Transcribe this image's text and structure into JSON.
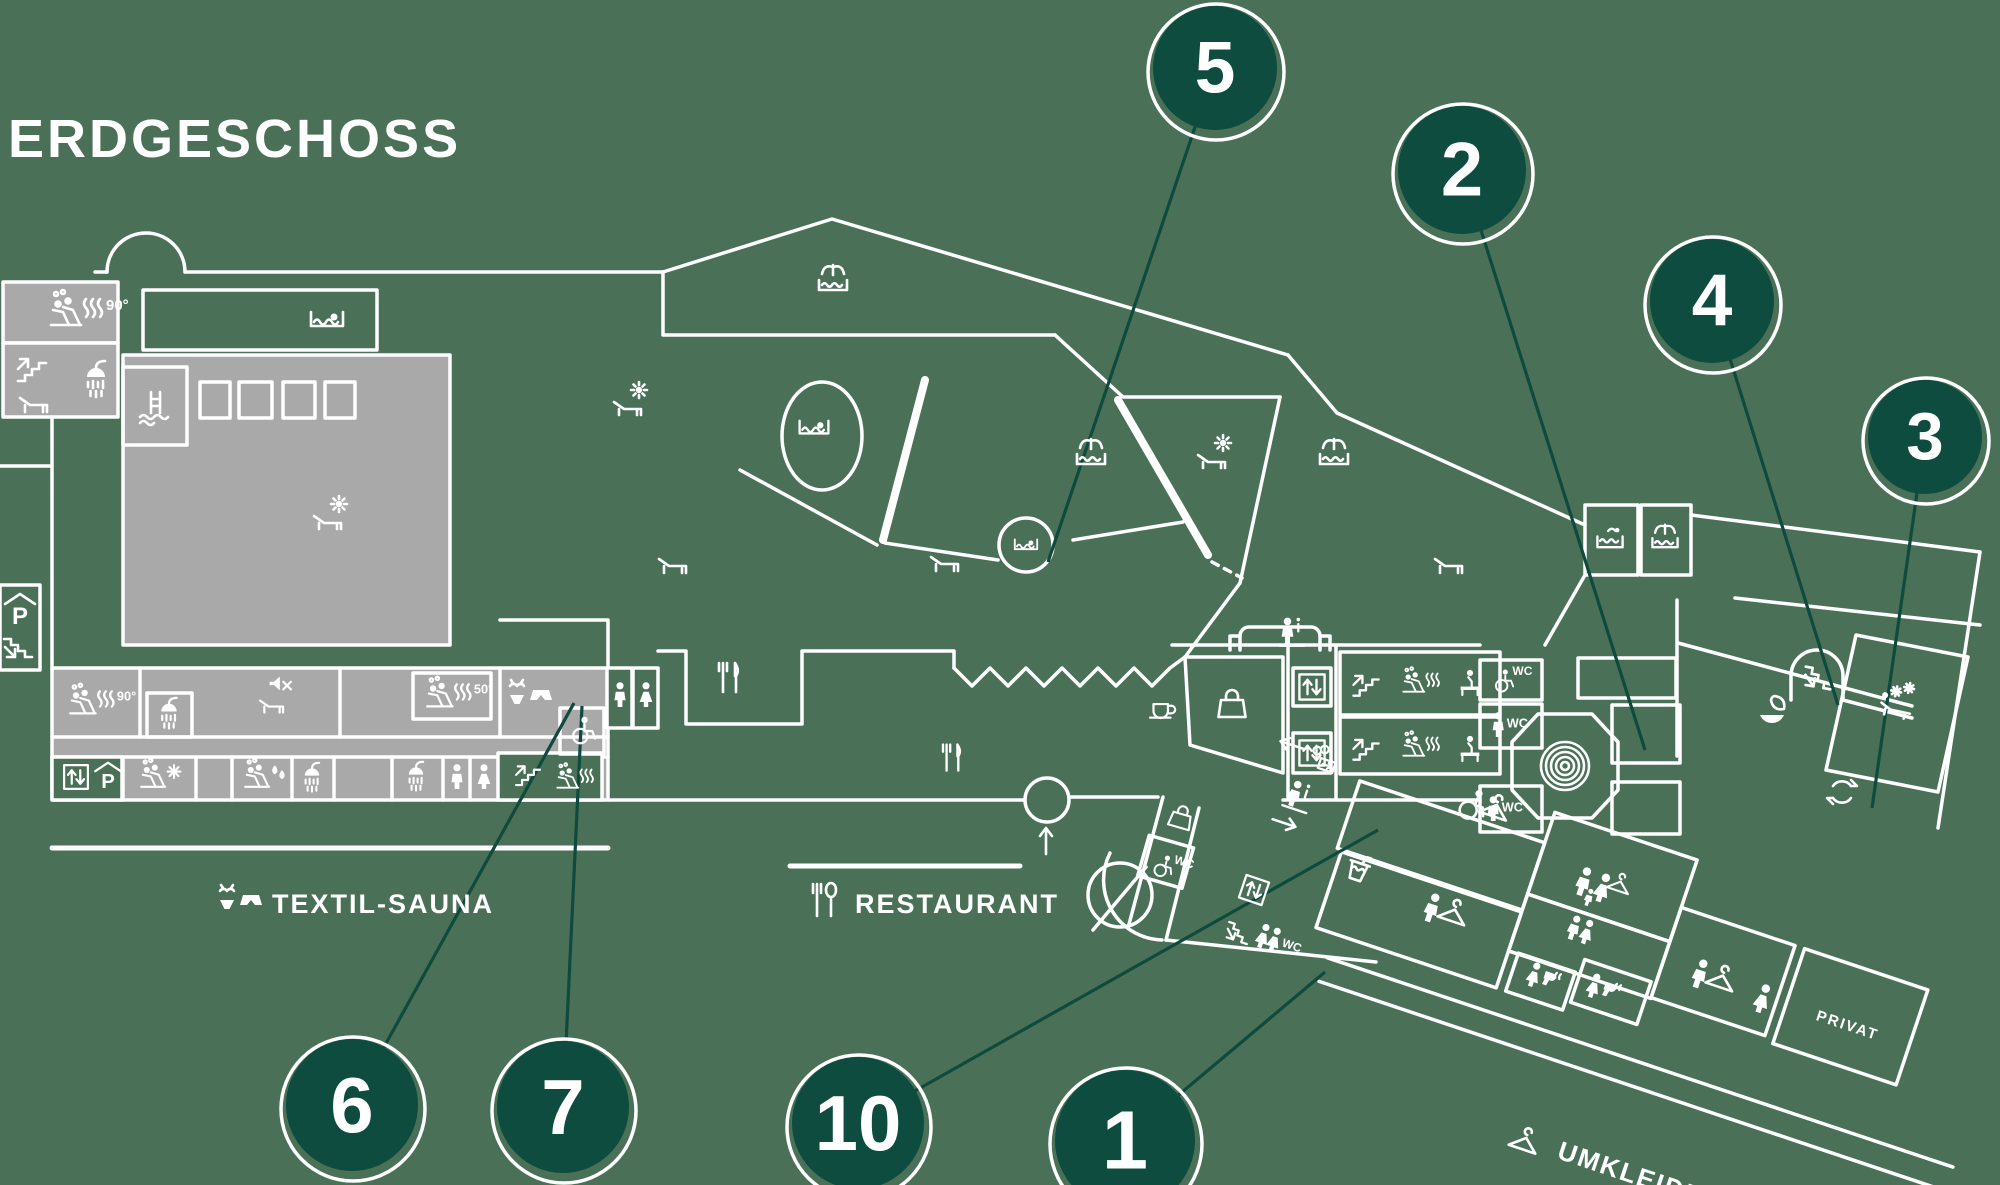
{
  "page": {
    "title": "ERDGESCHOSS"
  },
  "colors": {
    "background": "#4a7157",
    "wall": "#ffffff",
    "area_gray": "#a9a9a9",
    "marker_fill": "#0d4c3e",
    "marker_ring": "#ffffff",
    "leader_line": "#0e4a3d",
    "text": "#ffffff"
  },
  "section_labels": [
    {
      "id": "textil-sauna",
      "text": "TEXTIL-SAUNA",
      "x": 272,
      "y": 913,
      "size": 27,
      "rot": 0,
      "anchor": "start"
    },
    {
      "id": "restaurant",
      "text": "RESTAURANT",
      "x": 855,
      "y": 913,
      "size": 27,
      "rot": 0,
      "anchor": "start"
    },
    {
      "id": "umkleiden",
      "text": "UMKLEIDEN",
      "x": 1556,
      "y": 1158,
      "size": 26,
      "rot": 18.5,
      "anchor": "start"
    },
    {
      "id": "privat",
      "text": "PRIVAT",
      "x": 1846,
      "y": 1030,
      "size": 15,
      "rot": 18.5,
      "anchor": "middle"
    }
  ],
  "markers": [
    {
      "number": "5",
      "cx": 1215,
      "cy": 68,
      "r": 62,
      "tx": 1048,
      "ty": 562
    },
    {
      "number": "2",
      "cx": 1462,
      "cy": 170,
      "r": 64,
      "tx": 1645,
      "ty": 750
    },
    {
      "number": "4",
      "cx": 1712,
      "cy": 301,
      "r": 62,
      "tx": 1838,
      "ty": 705
    },
    {
      "number": "3",
      "cx": 1925,
      "cy": 437,
      "r": 57,
      "tx": 1872,
      "ty": 808
    },
    {
      "number": "6",
      "cx": 352,
      "cy": 1105,
      "r": 66,
      "tx": 574,
      "ty": 703
    },
    {
      "number": "7",
      "cx": 563,
      "cy": 1107,
      "r": 66,
      "tx": 582,
      "ty": 706
    },
    {
      "number": "10",
      "cx": 858,
      "cy": 1123,
      "r": 66,
      "tx": 1378,
      "ty": 830
    },
    {
      "number": "1",
      "cx": 1125,
      "cy": 1140,
      "r": 70,
      "tx": 1325,
      "ty": 972
    }
  ],
  "icons": [
    {
      "name": "sauna-people",
      "x": 72,
      "y": 314,
      "text": "90°"
    },
    {
      "name": "stairs-up",
      "x": 32,
      "y": 368
    },
    {
      "name": "shower",
      "x": 96,
      "y": 380
    },
    {
      "name": "lounger",
      "x": 34,
      "y": 402
    },
    {
      "name": "pool-ladder",
      "x": 155,
      "y": 408
    },
    {
      "name": "swimmer-pool",
      "x": 327,
      "y": 320
    },
    {
      "name": "sun-lounger",
      "x": 330,
      "y": 514
    },
    {
      "name": "parking",
      "x": 20,
      "y": 612
    },
    {
      "name": "stairs-down",
      "x": 18,
      "y": 648
    },
    {
      "name": "sauna-people",
      "x": 88,
      "y": 704,
      "text": "90°",
      "s": 0.85
    },
    {
      "name": "shower",
      "x": 169,
      "y": 714,
      "s": 0.85
    },
    {
      "name": "speaker-off",
      "x": 279,
      "y": 686,
      "s": 0.85
    },
    {
      "name": "lounger",
      "x": 272,
      "y": 704,
      "s": 0.85
    },
    {
      "name": "elevator",
      "x": 76,
      "y": 777,
      "s": 0.85
    },
    {
      "name": "parking",
      "x": 108,
      "y": 778,
      "s": 0.85
    },
    {
      "name": "sauna-snow",
      "x": 158,
      "y": 778,
      "s": 0.8
    },
    {
      "name": "sauna-drops",
      "x": 262,
      "y": 778,
      "s": 0.8
    },
    {
      "name": "shower",
      "x": 312,
      "y": 778,
      "s": 0.8
    },
    {
      "name": "shower",
      "x": 416,
      "y": 777,
      "s": 0.8
    },
    {
      "name": "man",
      "x": 457,
      "y": 778,
      "s": 0.85
    },
    {
      "name": "woman",
      "x": 484,
      "y": 778,
      "s": 0.85
    },
    {
      "name": "stairs-up",
      "x": 528,
      "y": 774,
      "s": 0.85
    },
    {
      "name": "sauna-people",
      "x": 572,
      "y": 780,
      "s": 0.7
    },
    {
      "name": "sauna-people",
      "x": 445,
      "y": 697,
      "text": "50°",
      "s": 0.85
    },
    {
      "name": "swimwear",
      "x": 530,
      "y": 697
    },
    {
      "name": "wheelchair",
      "x": 582,
      "y": 731,
      "s": 0.85
    },
    {
      "name": "man",
      "x": 620,
      "y": 696,
      "s": 0.85
    },
    {
      "name": "woman",
      "x": 646,
      "y": 696,
      "s": 0.85
    },
    {
      "name": "cutlery",
      "x": 729,
      "y": 678
    },
    {
      "name": "cutlery",
      "x": 952,
      "y": 758,
      "s": 0.9
    },
    {
      "name": "cup",
      "x": 1162,
      "y": 710,
      "s": 0.85
    },
    {
      "name": "arrow-up",
      "x": 1046,
      "y": 840
    },
    {
      "name": "bag",
      "x": 1181,
      "y": 818,
      "s": 0.8,
      "rot": 16
    },
    {
      "name": "wc-wheelchair",
      "x": 1166,
      "y": 866,
      "text": "WC",
      "s": 0.8,
      "rot": 16
    },
    {
      "name": "bag",
      "x": 1232,
      "y": 705
    },
    {
      "name": "info-desk",
      "x": 1292,
      "y": 634,
      "s": 0.9
    },
    {
      "name": "elevator",
      "x": 1312,
      "y": 687,
      "s": 0.9
    },
    {
      "name": "elevator",
      "x": 1312,
      "y": 753,
      "s": 0.9
    },
    {
      "name": "stairs-up",
      "x": 1366,
      "y": 684,
      "s": 0.9
    },
    {
      "name": "sauna-people",
      "x": 1418,
      "y": 684,
      "s": 0.7
    },
    {
      "name": "bench-person",
      "x": 1470,
      "y": 684,
      "s": 0.85
    },
    {
      "name": "stairs-up",
      "x": 1366,
      "y": 748,
      "s": 0.9
    },
    {
      "name": "sauna-people",
      "x": 1418,
      "y": 748,
      "s": 0.7
    },
    {
      "name": "bench-person",
      "x": 1470,
      "y": 750,
      "s": 0.85
    },
    {
      "name": "wc-wheelchair",
      "x": 1506,
      "y": 680,
      "text": "WC",
      "s": 0.8
    },
    {
      "name": "man-wc",
      "x": 1505,
      "y": 726,
      "text": "WC",
      "s": 0.85
    },
    {
      "name": "man-wc",
      "x": 1500,
      "y": 810,
      "text": "WC",
      "s": 0.85
    },
    {
      "name": "woman-wheel-locker",
      "x": 1645,
      "y": 728,
      "s": 0.85
    },
    {
      "name": "woman-wheel-locker",
      "x": 1645,
      "y": 806,
      "s": 0.85
    },
    {
      "name": "spiral",
      "x": 1565,
      "y": 766
    },
    {
      "name": "leaf",
      "x": 1772,
      "y": 712
    },
    {
      "name": "stairs-down",
      "x": 1818,
      "y": 678,
      "rot": 10
    },
    {
      "name": "cycle",
      "x": 1842,
      "y": 792
    },
    {
      "name": "snow-bed",
      "x": 1898,
      "y": 702,
      "rot": 12
    },
    {
      "name": "pool-waves",
      "x": 1610,
      "y": 540,
      "s": 0.9
    },
    {
      "name": "fountain-pool",
      "x": 1665,
      "y": 540,
      "s": 0.9
    },
    {
      "name": "fountain-pool",
      "x": 833,
      "y": 282
    },
    {
      "name": "sun-lounger",
      "x": 630,
      "y": 400
    },
    {
      "name": "swimmer-pool",
      "x": 814,
      "y": 428,
      "s": 0.9
    },
    {
      "name": "swimmer-pool",
      "x": 1026,
      "y": 545,
      "s": 0.7
    },
    {
      "name": "fountain-pool",
      "x": 1091,
      "y": 456
    },
    {
      "name": "sun-lounger",
      "x": 1214,
      "y": 453
    },
    {
      "name": "fountain-pool",
      "x": 1334,
      "y": 456
    },
    {
      "name": "lounger",
      "x": 673,
      "y": 563
    },
    {
      "name": "lounger",
      "x": 945,
      "y": 561
    },
    {
      "name": "lounger",
      "x": 1449,
      "y": 563
    },
    {
      "name": "info-desk",
      "x": 1298,
      "y": 798,
      "rot": 18.5,
      "s": 0.9
    },
    {
      "name": "arrow-left",
      "x": 1292,
      "y": 745,
      "rot": 18.5
    },
    {
      "name": "kasse",
      "x": 1324,
      "y": 760,
      "rot": 18.5,
      "s": 0.85
    },
    {
      "name": "arrow-right",
      "x": 1284,
      "y": 823,
      "rot": 18.5
    },
    {
      "name": "elevator",
      "x": 1254,
      "y": 890,
      "rot": 18.5,
      "s": 0.85
    },
    {
      "name": "stairs-down",
      "x": 1238,
      "y": 933,
      "rot": 18.5,
      "s": 0.85
    },
    {
      "name": "women-wc",
      "x": 1274,
      "y": 941,
      "text": "WC",
      "rot": 18.5,
      "s": 0.85
    },
    {
      "name": "drink",
      "x": 1358,
      "y": 870,
      "rot": 18.5
    },
    {
      "name": "wheel-hanger",
      "x": 1478,
      "y": 806,
      "rot": 18.5
    },
    {
      "name": "person-hanger",
      "x": 1440,
      "y": 912,
      "rot": 18.5
    },
    {
      "name": "family",
      "x": 1592,
      "y": 888,
      "rot": 18.5
    },
    {
      "name": "people-pair",
      "x": 1580,
      "y": 931,
      "rot": 18.5,
      "s": 0.85
    },
    {
      "name": "woman-dryer",
      "x": 1540,
      "y": 978,
      "rot": 18.5,
      "s": 0.85
    },
    {
      "name": "woman-dryer",
      "x": 1600,
      "y": 989,
      "rot": 18.5,
      "s": 0.85
    },
    {
      "name": "person-hanger",
      "x": 1708,
      "y": 978,
      "rot": 18.5
    },
    {
      "name": "woman",
      "x": 1762,
      "y": 1000,
      "rot": 18.5
    },
    {
      "name": "swimwear",
      "x": 240,
      "y": 902
    },
    {
      "name": "fork-spoon",
      "x": 824,
      "y": 900
    },
    {
      "name": "hanger",
      "x": 1522,
      "y": 1146,
      "rot": 18.5
    }
  ]
}
